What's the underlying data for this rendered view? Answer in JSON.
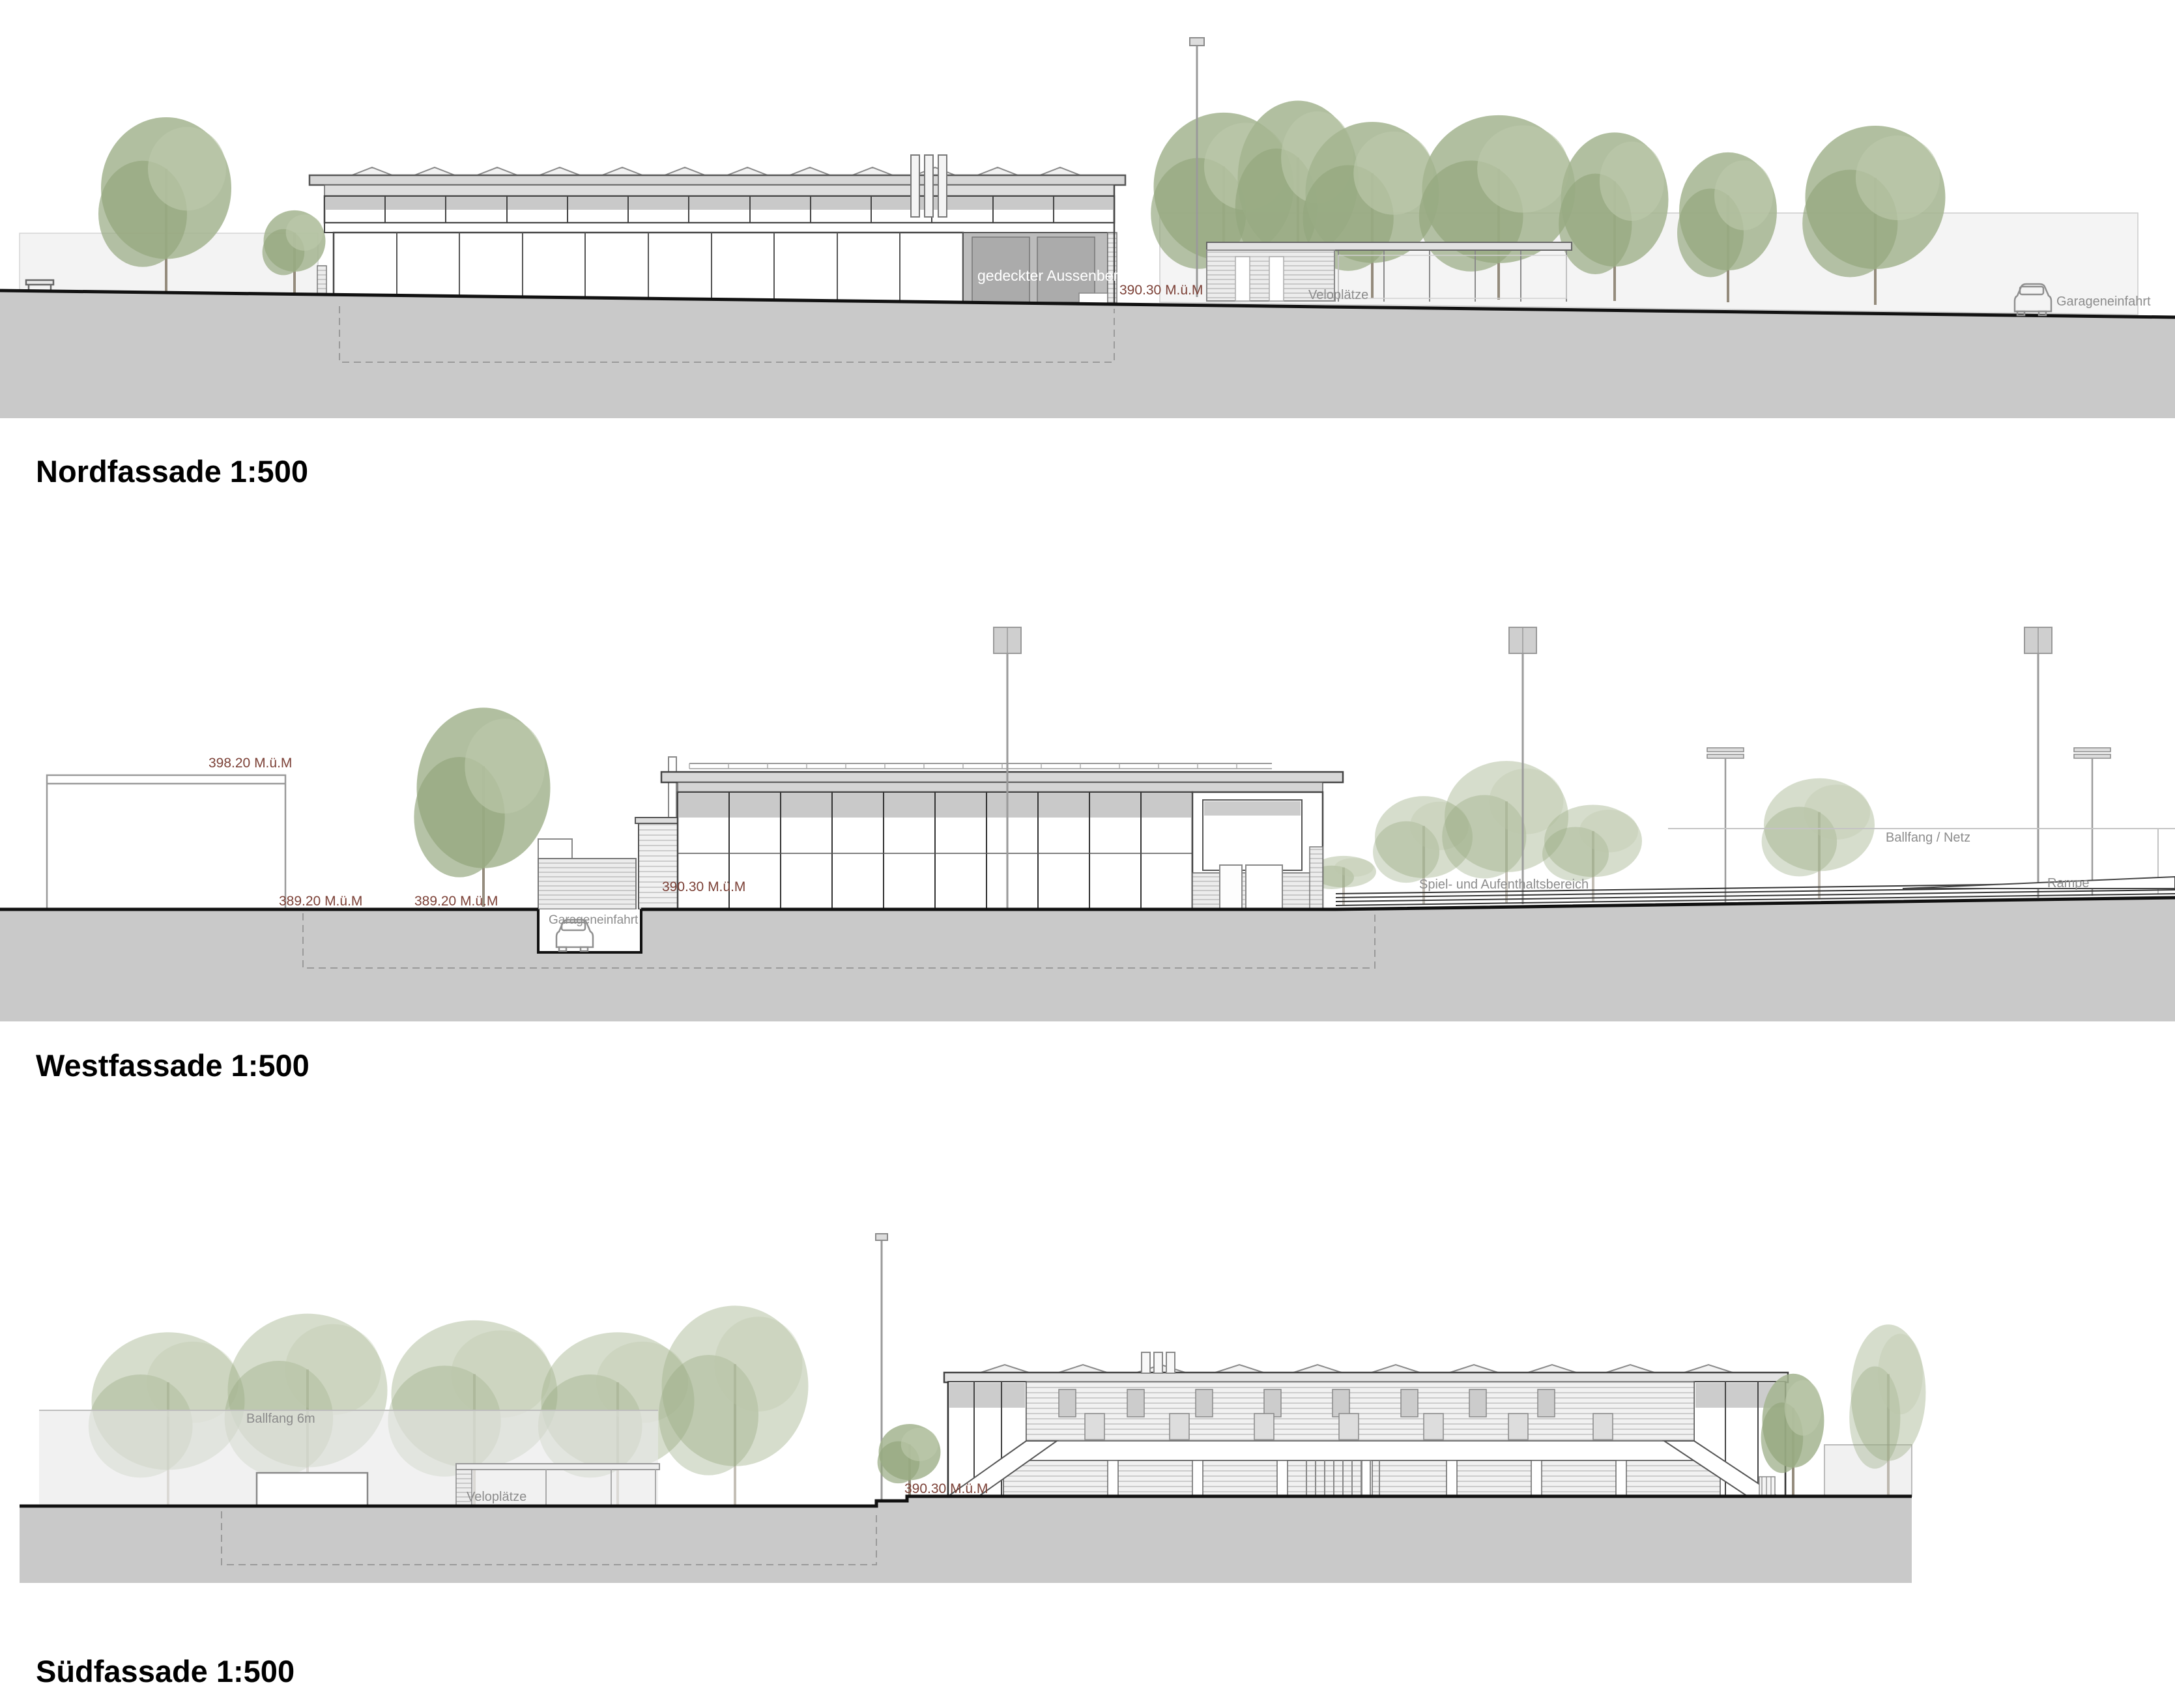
{
  "document": {
    "type": "architectural facade elevations",
    "scale": "1:500",
    "colors": {
      "level_label": "#7c4137",
      "annotation_gray": "#8c8c8c",
      "ground_fill": "#c9c9c9",
      "line": "#3a3a3a",
      "roof_gray": "#d6d6d6",
      "covered_area_gray": "#b5b5b5",
      "tree_green": "#9eae8c"
    }
  },
  "elevations": [
    {
      "id": "nord",
      "title": "Nordfassade 1:500",
      "labels": {
        "covered_area": "gedeckter Aussenbereich",
        "level_ground": "390.30 M.ü.M",
        "bike_parking": "Veloplätze",
        "garage_entry": "Garageneinfahrt"
      }
    },
    {
      "id": "west",
      "title": "Westfassade 1:500",
      "labels": {
        "level_top": "398.20 M.ü.M",
        "level_left_a": "389.20 M.ü.M",
        "level_left_b": "389.20 M.ü.M",
        "level_building": "390.30 M.ü.M",
        "garage_entry": "Garageneinfahrt",
        "play_area": "Spiel- und Aufenthaltsbereich",
        "ball_catch": "Ballfang / Netz",
        "ramp": "Rampe"
      }
    },
    {
      "id": "sued",
      "title": "Südfassade 1:500",
      "labels": {
        "ball_catch": "Ballfang 6m",
        "bike_parking": "Veloplätze",
        "level_ground": "390.30 M.ü.M"
      }
    }
  ]
}
